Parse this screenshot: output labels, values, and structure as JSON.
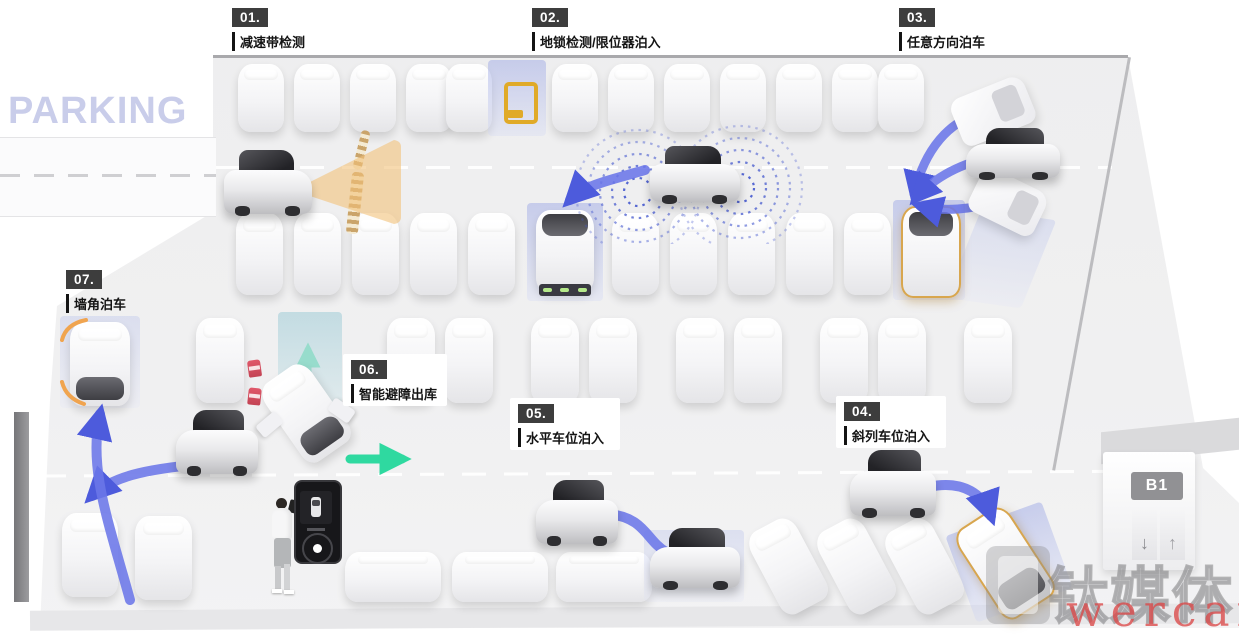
{
  "scene": {
    "parking_sign": "PARKING"
  },
  "labels": [
    {
      "num": "01.",
      "text": "减速带检测"
    },
    {
      "num": "02.",
      "text": "地锁检测/限位器泊入"
    },
    {
      "num": "03.",
      "text": "任意方向泊车"
    },
    {
      "num": "04.",
      "text": "斜列车位泊入"
    },
    {
      "num": "05.",
      "text": "水平车位泊入"
    },
    {
      "num": "06.",
      "text": "智能避障出库"
    },
    {
      "num": "07.",
      "text": "墙角泊车"
    }
  ],
  "elevator": {
    "floor_label": "B1",
    "down_arrow": "↓",
    "up_arrow": "↑"
  },
  "watermark": {
    "brand": "钛媒体",
    "sub": "wercar"
  },
  "colors": {
    "accent_blue": "#5b68de",
    "highlight_lavender": "#c9cff2",
    "highlight_teal": "#cfe4e8",
    "accent_orange": "#e8a94e",
    "accent_green": "#2fd9a0",
    "badge_bg": "#3d3d3d",
    "parking_sign_text": "#c9cdea",
    "watermark_red": "#da4848",
    "ground_lock_yellow": "#e0aa28"
  },
  "icons": [
    "ground-lock-icon",
    "radar-dots-icon",
    "speed-bump-icon",
    "elevator-up-icon",
    "elevator-down-icon",
    "tmtpost-logo-icon",
    "phone-remote-icon"
  ]
}
